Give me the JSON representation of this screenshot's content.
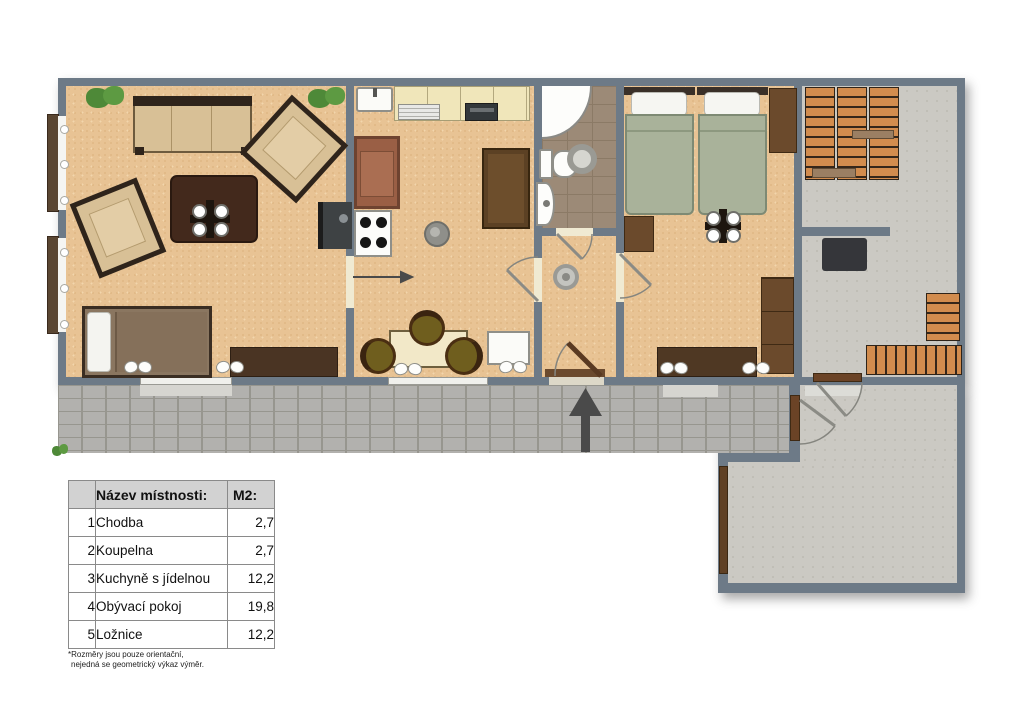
{
  "legend_table": {
    "header": {
      "num": "",
      "name": "Název místnosti:",
      "area": "M2:"
    },
    "rows": [
      {
        "num": "1",
        "name": "Chodba",
        "area": "2,7"
      },
      {
        "num": "2",
        "name": "Koupelna",
        "area": "2,7"
      },
      {
        "num": "3",
        "name": "Kuchyně s jídelnou",
        "area": "12,2"
      },
      {
        "num": "4",
        "name": "Obývací pokoj",
        "area": "19,8"
      },
      {
        "num": "5",
        "name": "Ložnice",
        "area": "12,2"
      }
    ],
    "footnote": {
      "line1": "*Rozměry jsou pouze orientační,",
      "line2": "nejedná se geometrický výkaz výměr."
    }
  },
  "colors": {
    "wall": "#6d7a87",
    "wood_floor": "#e8c394",
    "bath_tile": "#9c8a77",
    "storage_floor": "#cbc9c3",
    "paver": "#b2b1ae",
    "sofa_beige": "#d8c096",
    "dark_furniture": "#43291c",
    "bed_green": "#a9b29a",
    "wood_stack": "#d28c4e",
    "arrow": "#4a4a4a",
    "table_header_bg": "#d2d2d2"
  },
  "icons": {
    "entrance_arrow": "arrow-up",
    "sliding_door_arrow": "arrow-right"
  }
}
